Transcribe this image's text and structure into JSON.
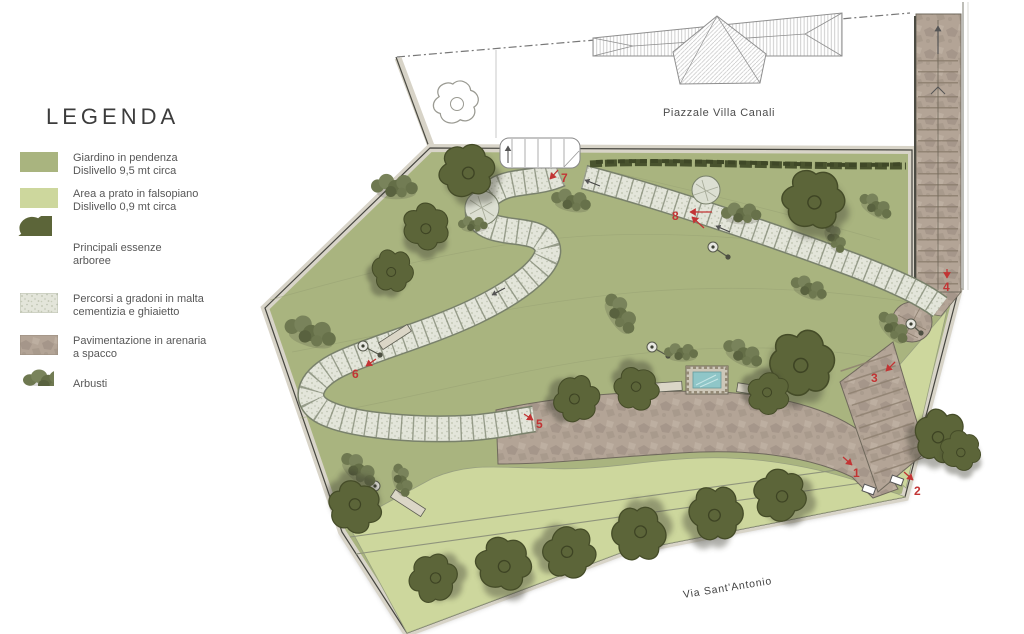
{
  "legend": {
    "title": "LEGENDA",
    "items": [
      {
        "line1": "Giardino in pendenza",
        "line2": "Dislivello 9,5 mt circa"
      },
      {
        "line1": "Area a prato in falsopiano",
        "line2": "Dislivello 0,9 mt circa"
      },
      {
        "line1": "Principali essenze",
        "line2": "arboree"
      },
      {
        "line1": "Percorsi a gradoni in malta",
        "line2": "cementizia e ghiaietto"
      },
      {
        "line1": "Pavimentazione in arenaria",
        "line2": "a spacco"
      },
      {
        "line1": "Arbusti",
        "line2": ""
      }
    ]
  },
  "map": {
    "labels": {
      "piazzale": "Piazzale Villa Canali",
      "street": "Via Sant'Antonio"
    },
    "markers": [
      "1",
      "2",
      "3",
      "4",
      "5",
      "6",
      "7",
      "8"
    ],
    "colors": {
      "garden_slope": "#a9b47f",
      "lawn": "#cdd79d",
      "gravel_path": "#e3e5da",
      "sandstone": "#b3a496",
      "tree": "#5c6539",
      "marker_red": "#c23434",
      "water": "#8fc6c8"
    }
  }
}
